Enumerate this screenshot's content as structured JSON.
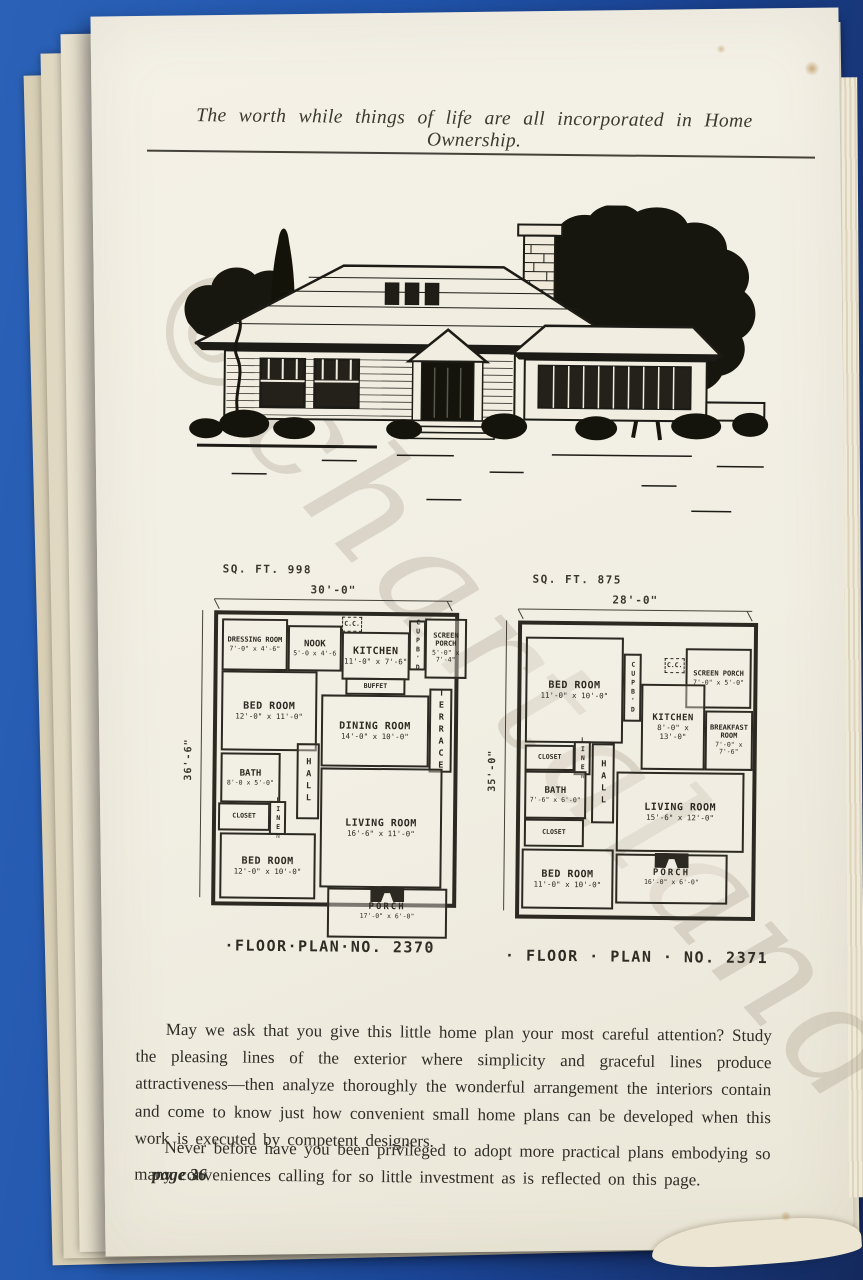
{
  "header": {
    "motto": "The worth while things of life are all incorporated in Home Ownership."
  },
  "watermark": {
    "text": "©chartaland"
  },
  "plans": [
    {
      "sqft_label": "SQ. FT. 998",
      "width_dim": "30'-0\"",
      "side_dim": "36'-6\"",
      "caption": "·FLOOR·PLAN·NO. 2370",
      "rooms": {
        "dressing_room": {
          "label": "DRESSING ROOM",
          "size": "7'-0\" x 4'-6\""
        },
        "nook": {
          "label": "NOOK",
          "size": "5'-0 x 4'-6"
        },
        "cc": {
          "label": "C.C."
        },
        "kitchen": {
          "label": "KITCHEN",
          "size": "11'-0\" x 7'-6\""
        },
        "cupboard": {
          "label": "CUPB'D"
        },
        "screen_porch": {
          "label": "SCREEN PORCH",
          "size": "5'-0\" x 7'-4\""
        },
        "buffet": {
          "label": "BUFFET"
        },
        "bed_room_1": {
          "label": "BED ROOM",
          "size": "12'-0\" x 11'-0\""
        },
        "dining_room": {
          "label": "DINING ROOM",
          "size": "14'-0\" x 10'-0\""
        },
        "terrace": {
          "label": "TERRACE"
        },
        "bath": {
          "label": "BATH",
          "size": "8'-0 x 5'-0\""
        },
        "hall": {
          "label": "HALL"
        },
        "closet": {
          "label": "CLOSET"
        },
        "linen": {
          "label": "LINEN"
        },
        "living_room": {
          "label": "LIVING ROOM",
          "size": "16'-6\" x 11'-0\""
        },
        "bed_room_2": {
          "label": "BED ROOM",
          "size": "12'-0\" x 10'-0\""
        },
        "porch": {
          "label": "PORCH",
          "size": "17'-0\" x 6'-0\""
        }
      }
    },
    {
      "sqft_label": "SQ. FT. 875",
      "width_dim": "28'-0\"",
      "side_dim": "35'-0\"",
      "caption": "· FLOOR · PLAN · NO. 2371",
      "rooms": {
        "bed_room_1": {
          "label": "BED ROOM",
          "size": "11'-0\" x 10'-0\""
        },
        "cupboard": {
          "label": "CUPB'D"
        },
        "cc": {
          "label": "C.C."
        },
        "screen_porch": {
          "label": "SCREEN PORCH",
          "size": "7'-0\" x 5'-0\""
        },
        "kitchen": {
          "label": "KITCHEN",
          "size": "8'-0\" x 13'-0\""
        },
        "breakfast_room": {
          "label": "BREAKFAST ROOM",
          "size": "7'-0\" x 7'-6\""
        },
        "closet_1": {
          "label": "CLOSET"
        },
        "linen": {
          "label": "LINEN"
        },
        "bath": {
          "label": "BATH",
          "size": "7'-6\" x 6'-0\""
        },
        "hall": {
          "label": "HALL"
        },
        "closet_2": {
          "label": "CLOSET"
        },
        "living_room": {
          "label": "LIVING ROOM",
          "size": "15'-6\" x 12'-0\""
        },
        "bed_room_2": {
          "label": "BED ROOM",
          "size": "11'-0\" x 10'-0\""
        },
        "porch": {
          "label": "PORCH",
          "size": "16'-0\" x 6'-0\""
        }
      }
    }
  ],
  "body": {
    "paragraph_1": "May we ask that you give this little home plan your most careful attention? Study the pleasing lines of the exterior where simplicity and graceful lines produce attractiveness—then analyze thoroughly the wonderful arrangement the interiors contain and come to know just how convenient small home plans can be developed when this work is executed by competent designers.",
    "paragraph_2": "Never before have you been privileged to adopt more practical plans embodying so many conveniences calling for so little investment as is reflected on this page."
  },
  "footer": {
    "page_number": "page 36"
  }
}
